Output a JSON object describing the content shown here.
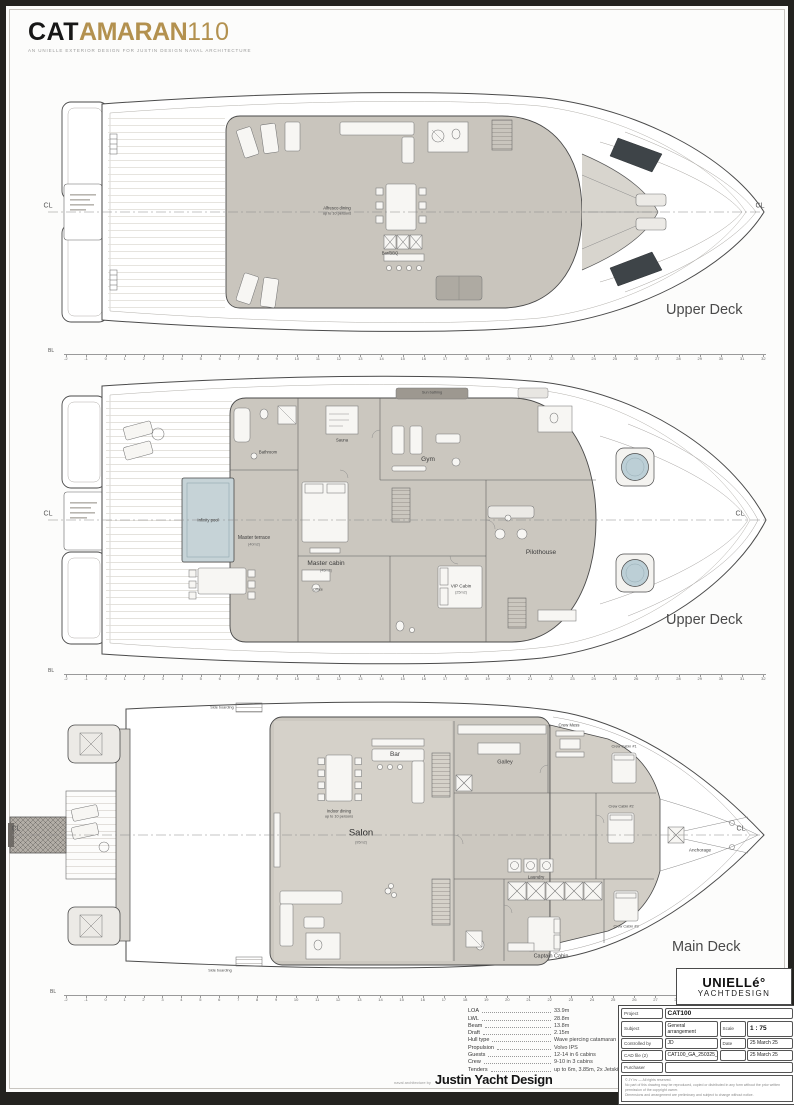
{
  "header": {
    "logo_cat": "CAT",
    "logo_amaran": "AMARAN",
    "logo_num": "110",
    "tagline": "AN UNIELLE EXTERIOR DESIGN FOR JUSTIN DESIGN NAVAL ARCHITECTURE"
  },
  "rulers": {
    "bl": "BL",
    "ticks": [
      "-2",
      "-1",
      "0",
      "1",
      "2",
      "3",
      "4",
      "5",
      "6",
      "7",
      "8",
      "9",
      "10",
      "11",
      "12",
      "13",
      "14",
      "15",
      "16",
      "17",
      "18",
      "19",
      "20",
      "21",
      "22",
      "23",
      "24",
      "25",
      "26",
      "27",
      "28",
      "29",
      "30",
      "31",
      "32"
    ]
  },
  "decks": {
    "flybridge": {
      "deck_label": "Upper Deck",
      "cl": "CL",
      "labels": {
        "alfresco_1": "Alfresco dining",
        "alfresco_2": "up to 10 persons",
        "bar_bbq": "Bar/BBQ"
      }
    },
    "owners": {
      "deck_label": "Upper Deck",
      "cl": "CL",
      "labels": {
        "sun_bathing": "Sun bathing",
        "bathroom": "Bathroom",
        "sauna": "Sauna",
        "gym": "Gym",
        "infinity_pool": "Infinity pool",
        "master_terrace": "Master terrace",
        "master_terrace_area": "(40m2)",
        "master_cabin": "Master cabin",
        "master_cabin_area": "(45m2)",
        "office": "Office",
        "vip_cabin": "VIP Cabin",
        "vip_cabin_area": "(25m2)",
        "pilothouse": "Pilothouse"
      }
    },
    "main": {
      "deck_label": "Main Deck",
      "cl": "CL",
      "labels": {
        "side_boarding_top": "Side boarding",
        "side_boarding_bottom": "Side boarding",
        "indoor_dining_1": "Indoor dining",
        "indoor_dining_2": "up to 10 persons",
        "bar": "Bar",
        "salon": "Salon",
        "salon_area": "(95m2)",
        "galley": "Galley",
        "crew_mess": "Crew Mess",
        "crew_cabin_1": "Crew Cabin #1",
        "crew_cabin_2": "Crew Cabin #2",
        "crew_cabin_3": "Crew Cabin #3",
        "laundry": "Laundry",
        "captain_cabin": "Captain Cabin",
        "anchorage": "Anchorage"
      }
    }
  },
  "specs": {
    "rows": [
      {
        "label": "LOA",
        "value": "33.9m"
      },
      {
        "label": "LWL",
        "value": "28.8m"
      },
      {
        "label": "Beam",
        "value": "13.8m"
      },
      {
        "label": "Draft",
        "value": "2.15m"
      },
      {
        "label": "Hull type",
        "value": "Wave piercing catamaran"
      },
      {
        "label": "Propulsion",
        "value": "Volvo IPS"
      },
      {
        "label": "Guests",
        "value": "12-14 in 6 cabins"
      },
      {
        "label": "Crew",
        "value": "9-10 in 3 cabins"
      },
      {
        "label": "Tenders",
        "value": "up to 6m, 3.85m, 2x Jetski"
      }
    ]
  },
  "brand": {
    "name": "UNIELLé°",
    "sub": "YACHTDESIGN"
  },
  "titleblock": {
    "project_label": "Project",
    "project_value": "CAT100",
    "subject_label": "Subject",
    "subject_value": "General arrangement",
    "scale_label": "Scale",
    "scale_value": "1 : 75",
    "controlled_label": "Controlled by",
    "controlled_value": "JD",
    "date_label": "Date",
    "date_value": "25 March 25",
    "cad_label": "CAD file (2)",
    "cad_value": "CAT100_GA_250325_dwg",
    "cad_date_value": "25 March 25",
    "purchaser_label": "Purchaser",
    "purchaser_value": "",
    "fine_print_1": "© JY bv — All rights reserved.",
    "fine_print_2": "No part of this drawing may be reproduced, copied or distributed in any form without the prior written permission of the copyright owner.",
    "fine_print_3": "Dimensions and arrangement are preliminary and subject to change without notice."
  },
  "footer": {
    "credit": "naval architecture by",
    "name": "Justin Yacht Design"
  }
}
